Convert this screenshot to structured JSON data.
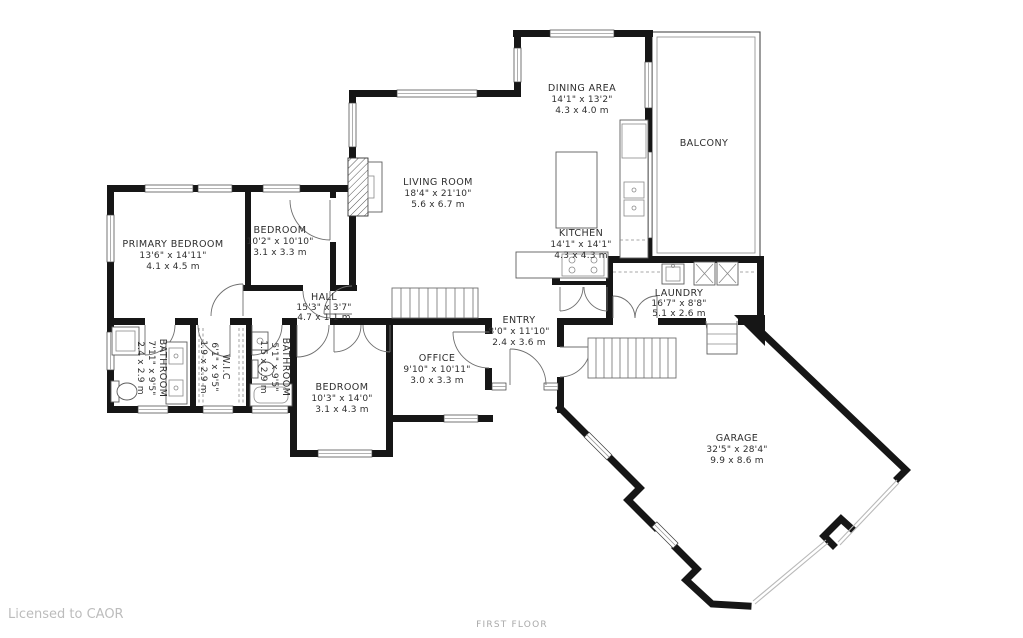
{
  "meta": {
    "license_text": "Licensed to CAOR",
    "floor_label": "FIRST FLOOR"
  },
  "colors": {
    "wall": "#161616",
    "room_text": "#2f2f2f",
    "muted_text": "#bcbcbc",
    "background": "#ffffff"
  },
  "rooms": [
    {
      "id": "primary-bedroom",
      "name": "PRIMARY BEDROOM",
      "imperial": "13'6\" x 14'11\"",
      "metric": "4.1 x 4.5 m"
    },
    {
      "id": "bedroom-2",
      "name": "BEDROOM",
      "imperial": "10'2\" x 10'10\"",
      "metric": "3.1 x 3.3 m"
    },
    {
      "id": "hall",
      "name": "HALL",
      "imperial": "15'3\" x 3'7\"",
      "metric": "4.7 x 1.1 m"
    },
    {
      "id": "living-room",
      "name": "LIVING ROOM",
      "imperial": "18'4\" x 21'10\"",
      "metric": "5.6 x 6.7 m"
    },
    {
      "id": "dining-area",
      "name": "DINING AREA",
      "imperial": "14'1\" x 13'2\"",
      "metric": "4.3 x 4.0 m"
    },
    {
      "id": "balcony",
      "name": "BALCONY",
      "imperial": "",
      "metric": ""
    },
    {
      "id": "kitchen",
      "name": "KITCHEN",
      "imperial": "14'1\" x 14'1\"",
      "metric": "4.3 x 4.3 m"
    },
    {
      "id": "laundry",
      "name": "LAUNDRY",
      "imperial": "16'7\" x 8'8\"",
      "metric": "5.1 x 2.6 m"
    },
    {
      "id": "entry",
      "name": "ENTRY",
      "imperial": "8'0\" x 11'10\"",
      "metric": "2.4 x 3.6 m"
    },
    {
      "id": "office",
      "name": "OFFICE",
      "imperial": "9'10\" x 10'11\"",
      "metric": "3.0 x 3.3 m"
    },
    {
      "id": "bedroom-3",
      "name": "BEDROOM",
      "imperial": "10'3\" x 14'0\"",
      "metric": "3.1 x 4.3 m"
    },
    {
      "id": "garage",
      "name": "GARAGE",
      "imperial": "32'5\" x 28'4\"",
      "metric": "9.9 x 8.6 m"
    },
    {
      "id": "bathroom-1",
      "name": "BATHROOM",
      "imperial": "7'11\" x 9'5\"",
      "metric": "2.4 x 2.9 m"
    },
    {
      "id": "wic",
      "name": "W.I.C",
      "imperial": "6'1\" x 9'5\"",
      "metric": "1.9 x 2.9 m"
    },
    {
      "id": "bathroom-2",
      "name": "BATHROOM",
      "imperial": "5'1\" x 9'5\"",
      "metric": "1.5 x 2.9 m"
    }
  ]
}
